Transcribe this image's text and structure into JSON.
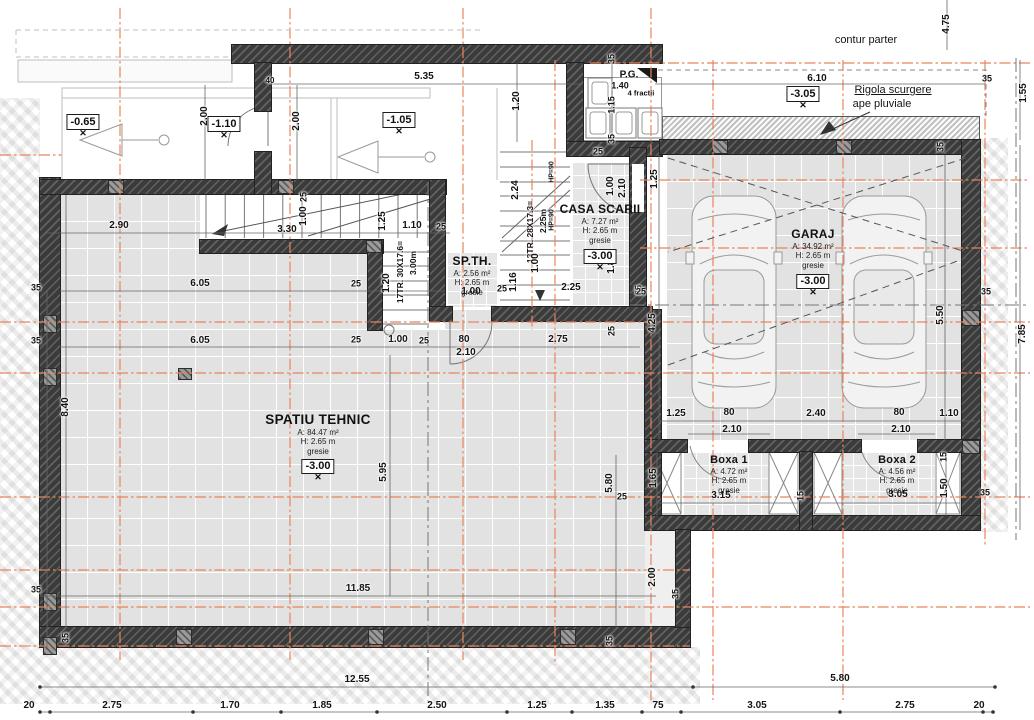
{
  "colors": {
    "axis_orange": "#e8845e",
    "wall_dark": "#3b3b3b",
    "floor_tile": "#e2e2e2",
    "dim_text": "#141414",
    "line_gray": "#666666"
  },
  "annotations": [
    {
      "text": "contur parter",
      "x": 866,
      "y": 40,
      "size": 11,
      "bold": false,
      "u": false
    },
    {
      "text": "Rigola scurgere",
      "x": 893,
      "y": 90,
      "size": 11,
      "bold": false,
      "u": true
    },
    {
      "text": "ape pluviale",
      "x": 882,
      "y": 104,
      "size": 11,
      "bold": false,
      "u": false
    },
    {
      "text": "P.G.",
      "x": 629,
      "y": 75,
      "size": 10,
      "bold": true,
      "u": false
    },
    {
      "text": "4 fractii",
      "x": 641,
      "y": 93,
      "size": 7.5,
      "bold": true,
      "u": false
    }
  ],
  "levels": [
    {
      "t": "-0.65",
      "x": 83,
      "y": 124
    },
    {
      "t": "-1.10",
      "x": 224,
      "y": 126
    },
    {
      "t": "-1.05",
      "x": 399,
      "y": 122
    },
    {
      "t": "-3.05",
      "x": 803,
      "y": 96
    }
  ],
  "rooms": [
    {
      "name": "SPATIU TEHNIC",
      "size": "lg",
      "area": "A: 84.47 m²",
      "height": "H: 2.65 m",
      "floor": "gresie",
      "level": "-3.00",
      "x": 318,
      "y": 412
    },
    {
      "name": "GARAJ",
      "size": "md",
      "area": "A: 34.92 m²",
      "height": "H: 2.65 m",
      "floor": "gresie",
      "level": "-3.00",
      "x": 813,
      "y": 228
    },
    {
      "name": "CASA SCARII",
      "size": "md",
      "area": "A: 7.27 m²",
      "height": "H: 2.65 m",
      "floor": "gresie",
      "level": "-3.00",
      "x": 600,
      "y": 203
    },
    {
      "name": "SP.TH.",
      "size": "md",
      "area": "A: 2.56 m²",
      "height": "H: 2.65 m",
      "floor": "gresie",
      "level": "",
      "x": 472,
      "y": 255
    },
    {
      "name": "Boxa 1",
      "size": "sm",
      "area": "A: 4.72 m²",
      "height": "H: 2.65 m",
      "floor": "gresie",
      "level": "",
      "x": 729,
      "y": 454
    },
    {
      "name": "Boxa 2",
      "size": "sm",
      "area": "A: 4.56 m²",
      "height": "H: 2.65 m",
      "floor": "gresie",
      "level": "",
      "x": 897,
      "y": 454
    }
  ],
  "dim_labels": [
    {
      "t": "4.75",
      "x": 947,
      "y": 24,
      "r": 90
    },
    {
      "t": "6.10",
      "x": 817,
      "y": 79
    },
    {
      "t": "35",
      "x": 987,
      "y": 79,
      "s": 9
    },
    {
      "t": "1.55",
      "x": 1024,
      "y": 93,
      "r": 90
    },
    {
      "t": "5.35",
      "x": 424,
      "y": 77
    },
    {
      "t": "2.00",
      "x": 205,
      "y": 116,
      "r": 90
    },
    {
      "t": "2.00",
      "x": 297,
      "y": 121,
      "r": 90
    },
    {
      "t": "1.20",
      "x": 517,
      "y": 101,
      "r": 90
    },
    {
      "t": "40",
      "x": 270,
      "y": 81,
      "s": 8
    },
    {
      "t": "1.40",
      "x": 620,
      "y": 86,
      "s": 9
    },
    {
      "t": "1.15",
      "x": 612,
      "y": 105,
      "r": 90,
      "s": 9
    },
    {
      "t": "35",
      "x": 612,
      "y": 59,
      "r": 90,
      "s": 9
    },
    {
      "t": "35",
      "x": 612,
      "y": 139,
      "r": 90,
      "s": 9
    },
    {
      "t": "35",
      "x": 941,
      "y": 147,
      "r": 90,
      "s": 9
    },
    {
      "t": "2.90",
      "x": 119,
      "y": 226
    },
    {
      "t": "3.30",
      "x": 287,
      "y": 230
    },
    {
      "t": "25",
      "x": 304,
      "y": 197,
      "r": 90,
      "s": 9
    },
    {
      "t": "1.00",
      "x": 304,
      "y": 216,
      "r": 90
    },
    {
      "t": "1.25",
      "x": 383,
      "y": 221,
      "r": 90
    },
    {
      "t": "1.10",
      "x": 412,
      "y": 226
    },
    {
      "t": "25",
      "x": 441,
      "y": 227,
      "s": 9
    },
    {
      "t": "6.05",
      "x": 200,
      "y": 284
    },
    {
      "t": "25",
      "x": 356,
      "y": 284,
      "s": 9
    },
    {
      "t": "1.20",
      "x": 387,
      "y": 283,
      "r": 90
    },
    {
      "t": "17TR. 30X17.6=",
      "x": 400,
      "y": 272,
      "r": 90,
      "s": 8.5
    },
    {
      "t": "3.00m",
      "x": 413,
      "y": 263,
      "r": 90,
      "s": 8.5
    },
    {
      "t": "6.05",
      "x": 200,
      "y": 341
    },
    {
      "t": "25",
      "x": 356,
      "y": 340,
      "s": 9
    },
    {
      "t": "1.00",
      "x": 398,
      "y": 340
    },
    {
      "t": "25",
      "x": 424,
      "y": 341,
      "s": 9
    },
    {
      "t": "80",
      "x": 464,
      "y": 340
    },
    {
      "t": "2.10",
      "x": 466,
      "y": 353
    },
    {
      "t": "2.75",
      "x": 558,
      "y": 340
    },
    {
      "t": "25",
      "x": 612,
      "y": 331,
      "r": 90,
      "s": 9
    },
    {
      "t": "8.40",
      "x": 66,
      "y": 407,
      "r": 90
    },
    {
      "t": "35",
      "x": 36,
      "y": 288,
      "s": 9
    },
    {
      "t": "35",
      "x": 36,
      "y": 341,
      "s": 9
    },
    {
      "t": "35",
      "x": 36,
      "y": 590,
      "s": 9
    },
    {
      "t": "35",
      "x": 66,
      "y": 638,
      "r": 90,
      "s": 9
    },
    {
      "t": "5.95",
      "x": 384,
      "y": 472,
      "r": 90
    },
    {
      "t": "11.85",
      "x": 358,
      "y": 589
    },
    {
      "t": "5.80",
      "x": 610,
      "y": 483,
      "r": 90
    },
    {
      "t": "2.00",
      "x": 653,
      "y": 577,
      "r": 90
    },
    {
      "t": "35",
      "x": 676,
      "y": 594,
      "r": 90,
      "s": 9
    },
    {
      "t": "35",
      "x": 610,
      "y": 641,
      "r": 90,
      "s": 9
    },
    {
      "t": "25",
      "x": 622,
      "y": 497,
      "s": 9
    },
    {
      "t": "2.24",
      "x": 516,
      "y": 190,
      "r": 90
    },
    {
      "t": "13TR. 28X17.3=",
      "x": 530,
      "y": 232,
      "r": 90,
      "s": 8.5
    },
    {
      "t": "2.25m",
      "x": 543,
      "y": 221,
      "r": 90,
      "s": 8.5
    },
    {
      "t": "HP=90",
      "x": 552,
      "y": 172,
      "r": 90,
      "s": 7
    },
    {
      "t": "HP=90",
      "x": 552,
      "y": 220,
      "r": 90,
      "s": 7
    },
    {
      "t": "1.00",
      "x": 536,
      "y": 263,
      "r": 90
    },
    {
      "t": "1.16",
      "x": 514,
      "y": 282,
      "r": 90
    },
    {
      "t": "2.25",
      "x": 571,
      "y": 288
    },
    {
      "t": "25",
      "x": 639,
      "y": 290,
      "r": 90,
      "s": 9
    },
    {
      "t": "1.00",
      "x": 611,
      "y": 186,
      "r": 90
    },
    {
      "t": "2.10",
      "x": 623,
      "y": 188,
      "r": 90
    },
    {
      "t": "1.25",
      "x": 655,
      "y": 179,
      "r": 90
    },
    {
      "t": "25",
      "x": 598,
      "y": 152,
      "s": 9
    },
    {
      "t": "1.85",
      "x": 612,
      "y": 264,
      "r": 90
    },
    {
      "t": "1.00",
      "x": 471,
      "y": 292
    },
    {
      "t": "25",
      "x": 502,
      "y": 289,
      "s": 9
    },
    {
      "t": "6.35",
      "x": 811,
      "y": 287
    },
    {
      "t": "4.25",
      "x": 653,
      "y": 323,
      "r": 90
    },
    {
      "t": "5.50",
      "x": 941,
      "y": 315,
      "r": 90
    },
    {
      "t": "7.85",
      "x": 1023,
      "y": 334,
      "r": 90
    },
    {
      "t": "25",
      "x": 641,
      "y": 292,
      "s": 9
    },
    {
      "t": "35",
      "x": 986,
      "y": 292,
      "s": 9
    },
    {
      "t": "1.25",
      "x": 676,
      "y": 414
    },
    {
      "t": "80",
      "x": 729,
      "y": 413
    },
    {
      "t": "2.40",
      "x": 816,
      "y": 414
    },
    {
      "t": "80",
      "x": 899,
      "y": 413
    },
    {
      "t": "1.10",
      "x": 949,
      "y": 414
    },
    {
      "t": "2.10",
      "x": 732,
      "y": 430
    },
    {
      "t": "2.10",
      "x": 901,
      "y": 430
    },
    {
      "t": "1.65",
      "x": 654,
      "y": 478,
      "r": 90
    },
    {
      "t": "3.15",
      "x": 721,
      "y": 496
    },
    {
      "t": "15",
      "x": 801,
      "y": 496,
      "r": 90,
      "s": 9
    },
    {
      "t": "15",
      "x": 944,
      "y": 457,
      "r": 90,
      "s": 9
    },
    {
      "t": "1.50",
      "x": 945,
      "y": 488,
      "r": 90
    },
    {
      "t": "3.05",
      "x": 898,
      "y": 495
    },
    {
      "t": "35",
      "x": 985,
      "y": 493,
      "s": 9
    },
    {
      "t": "12.55",
      "x": 357,
      "y": 680
    },
    {
      "t": "5.80",
      "x": 840,
      "y": 679
    },
    {
      "t": "20",
      "x": 29,
      "y": 706
    },
    {
      "t": "2.75",
      "x": 112,
      "y": 706
    },
    {
      "t": "1.70",
      "x": 230,
      "y": 706
    },
    {
      "t": "1.85",
      "x": 322,
      "y": 706
    },
    {
      "t": "2.50",
      "x": 437,
      "y": 706
    },
    {
      "t": "1.25",
      "x": 537,
      "y": 706
    },
    {
      "t": "1.35",
      "x": 605,
      "y": 706
    },
    {
      "t": "75",
      "x": 658,
      "y": 706
    },
    {
      "t": "3.05",
      "x": 757,
      "y": 706
    },
    {
      "t": "2.75",
      "x": 905,
      "y": 706
    },
    {
      "t": "20",
      "x": 979,
      "y": 706
    }
  ]
}
